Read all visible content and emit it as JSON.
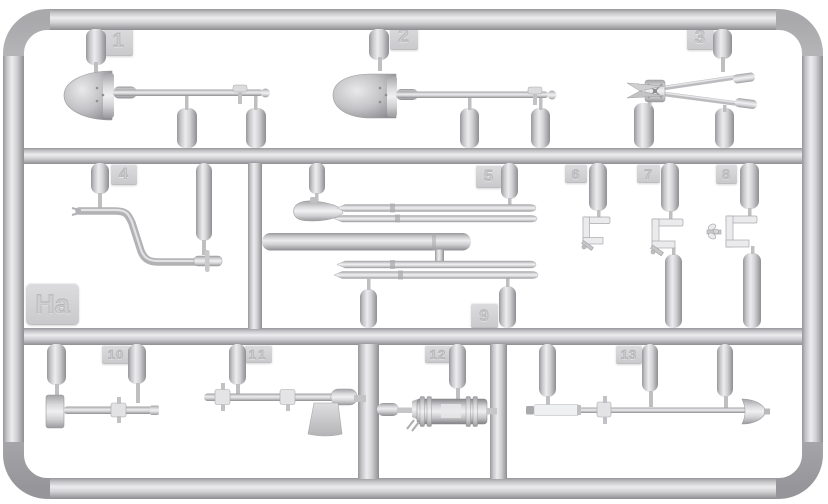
{
  "scene": {
    "description": "injection-molded model kit sprue with tools",
    "background": "#ffffff",
    "plastic_light": "#ececee",
    "plastic_mid": "#c6c6c8",
    "plastic_dark": "#95959a",
    "tag_bg": "#d2d2d4"
  },
  "sprue_tag": {
    "label": "Ha"
  },
  "tags": [
    {
      "label": "1",
      "part": "round-point-shovel"
    },
    {
      "label": "2",
      "part": "square-point-shovel"
    },
    {
      "label": "3",
      "part": "wire-cutters"
    },
    {
      "label": "4",
      "part": "starter-crank"
    },
    {
      "label": "5",
      "part": "pick-head-with-rods"
    },
    {
      "label": "6",
      "part": "tool-clamp-small"
    },
    {
      "label": "7",
      "part": "tool-clamp-medium"
    },
    {
      "label": "8",
      "part": "tool-clamp-wingnut"
    },
    {
      "label": "9",
      "part": "long-rods"
    },
    {
      "label": "10",
      "part": "sledgehammer"
    },
    {
      "label": "11",
      "part": "axe"
    },
    {
      "label": "12",
      "part": "grease-pump-cylinder"
    },
    {
      "label": "13",
      "part": "rod-with-spade-tip"
    }
  ]
}
